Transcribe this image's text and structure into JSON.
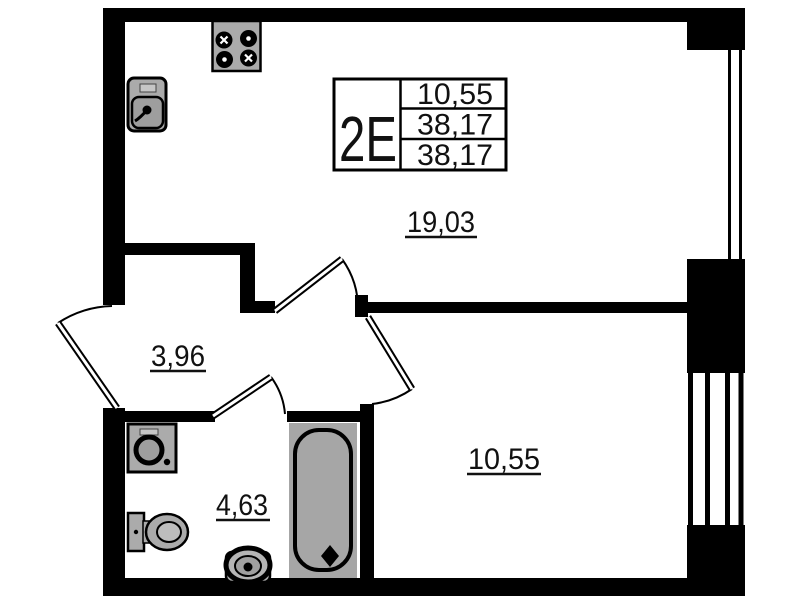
{
  "unit_card": {
    "type_label": "2Е",
    "living_area": "10,55",
    "total_area": "38,17",
    "total_area_reduced": "38,17"
  },
  "rooms": {
    "kitchen_living": {
      "area": "19,03"
    },
    "hallway": {
      "area": "3,96"
    },
    "bathroom": {
      "area": "4,63"
    },
    "bedroom": {
      "area": "10,55"
    }
  },
  "fixtures": {
    "stove": "4-burner stove",
    "kitchen_sink": "kitchen sink",
    "washing_machine": "washing machine",
    "toilet": "toilet",
    "washbasin": "washbasin",
    "bathtub": "bathtub"
  },
  "colors": {
    "walls": "#000000",
    "fixture_fill": "#ababab",
    "bathtub_fill": "#a6a6a6",
    "background": "#ffffff"
  }
}
